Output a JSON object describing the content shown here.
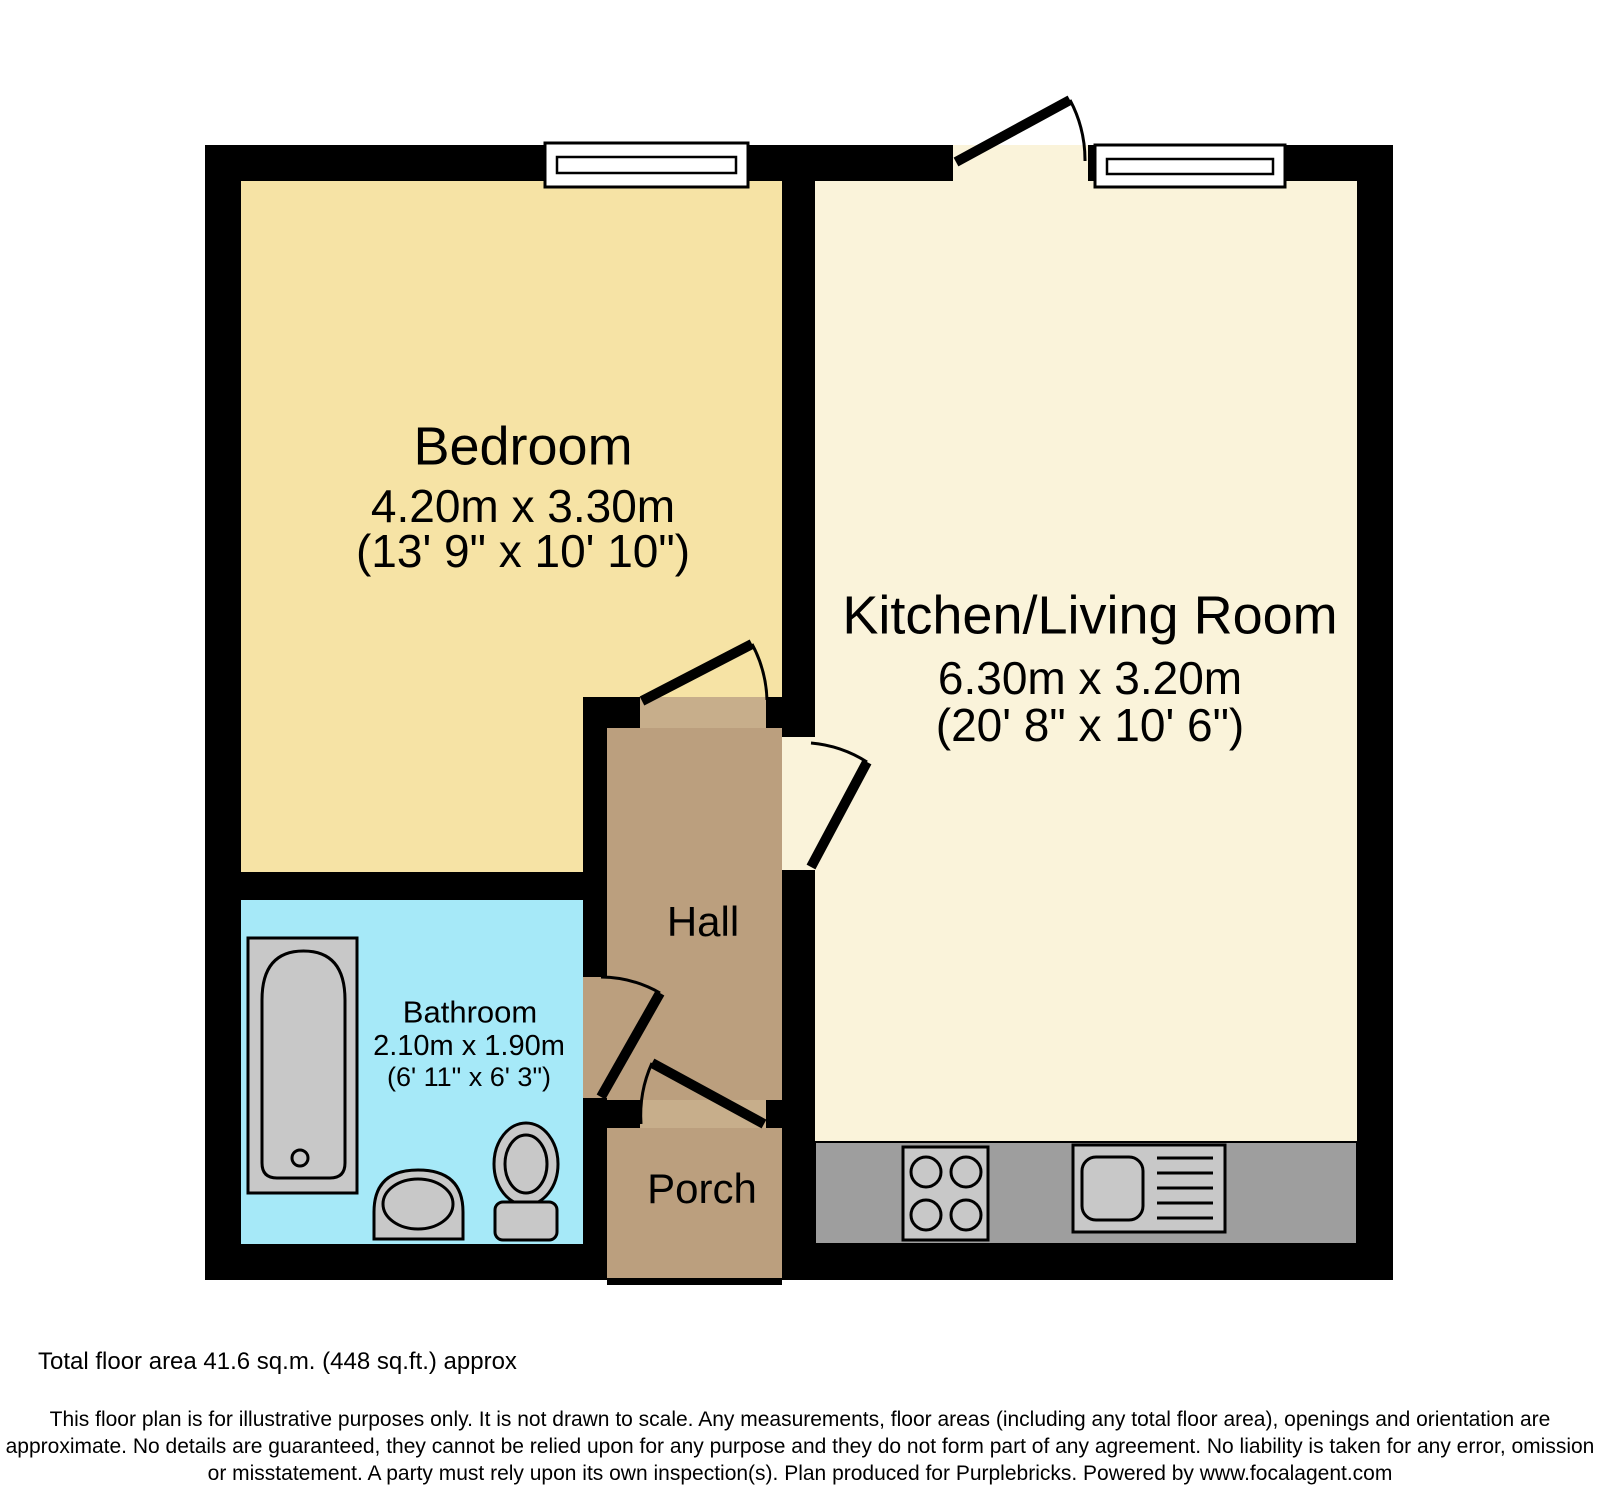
{
  "rooms": {
    "bedroom": {
      "name": "Bedroom",
      "dims_metric": "4.20m x 3.30m",
      "dims_imperial": "(13' 9\" x 10' 10\")"
    },
    "kitchen_living": {
      "name": "Kitchen/Living Room",
      "dims_metric": "6.30m x 3.20m",
      "dims_imperial": "(20' 8\" x 10' 6\")"
    },
    "bathroom": {
      "name": "Bathroom",
      "dims_metric": "2.10m x 1.90m",
      "dims_imperial": "(6' 11\" x 6' 3\")"
    },
    "hall": {
      "name": "Hall"
    },
    "porch": {
      "name": "Porch"
    }
  },
  "footer": {
    "total_area": "Total floor area 41.6 sq.m. (448 sq.ft.) approx",
    "disclaimer_line1": "This floor plan is for illustrative purposes only. It is not drawn to scale. Any measurements, floor areas (including any total floor area), openings and orientation are",
    "disclaimer_line2": "approximate. No details are guaranteed, they cannot be relied upon for any purpose and they do not form part of any agreement. No liability is taken for any error, omission",
    "disclaimer_line3": "or misstatement. A party must rely upon its own inspection(s). Plan produced for Purplebricks. Powered by www.focalagent.com"
  },
  "colors": {
    "wall": "#000000",
    "bedroom_floor": "#f6e3a5",
    "kitchen_floor": "#faf3da",
    "hall_floor": "#bb9f7e",
    "threshold": "#c7ae8b",
    "bathroom_floor": "#a6e9f8",
    "counter": "#9e9e9e",
    "fixture": "#c8c8c8",
    "window": "#ffffff"
  }
}
